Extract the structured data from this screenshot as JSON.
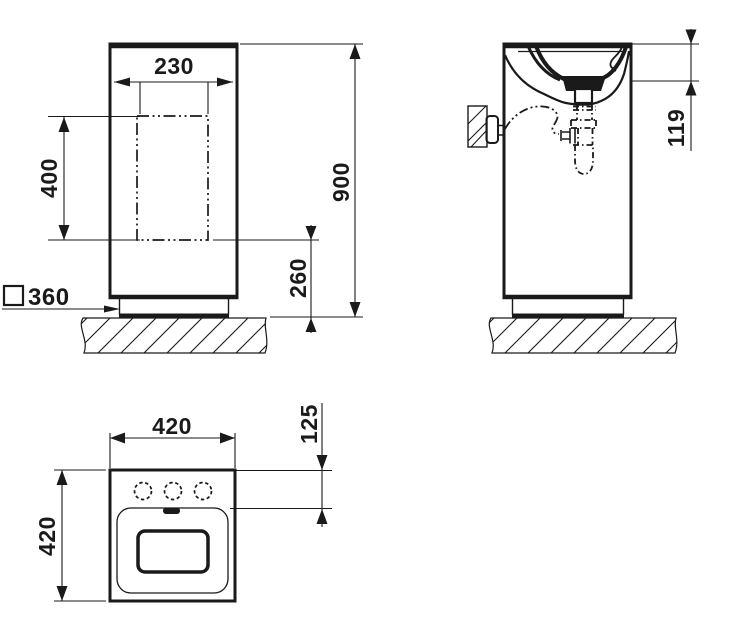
{
  "drawing": {
    "background": "#ffffff",
    "line_color": "#1a1a1a"
  },
  "views": {
    "front": {
      "dims": {
        "cutout_width": "230",
        "cutout_height": "400",
        "overall_height": "900",
        "cutout_to_floor": "260",
        "base_square": "360"
      }
    },
    "side": {
      "dims": {
        "rim_to_outlet": "119"
      }
    },
    "plan": {
      "dims": {
        "width": "420",
        "depth": "420",
        "front_edge_to_basin": "125"
      }
    }
  }
}
